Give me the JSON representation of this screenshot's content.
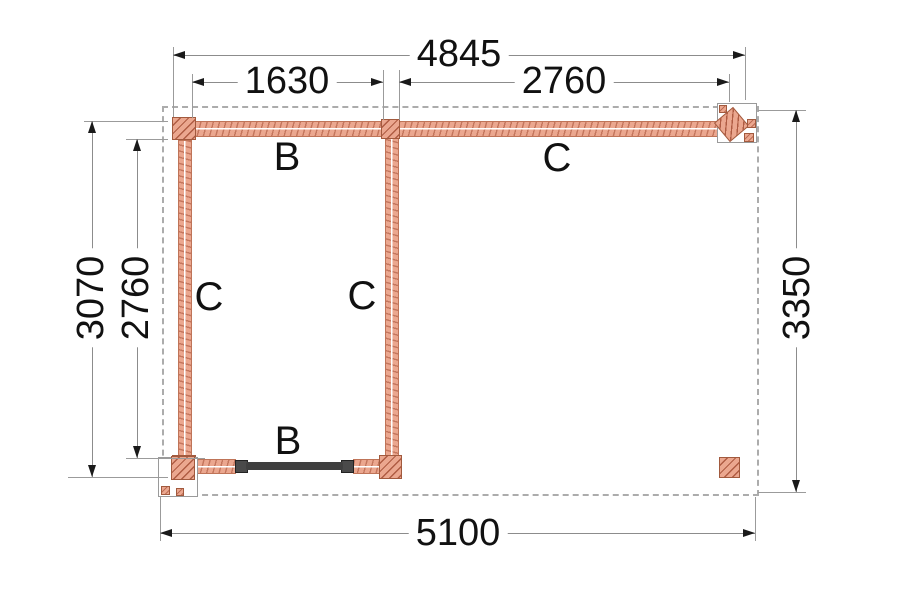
{
  "drawing_type": "veranda-floor-plan",
  "colors": {
    "beam_fill": "#eba78f",
    "beam_edge": "#bf7458",
    "hatch": "#a25a3e",
    "dimension_line": "#8c8c8c",
    "dimension_text": "#111111",
    "roof_outline_dash": "#acacac",
    "dark_bar": "#3f3f3f",
    "background": "#ffffff"
  },
  "dimensions": {
    "top_overall": {
      "label": "4845"
    },
    "top_left_bay": {
      "label": "1630"
    },
    "top_right_bay": {
      "label": "2760"
    },
    "left_outer": {
      "label": "3070"
    },
    "left_inner": {
      "label": "2760"
    },
    "right_side": {
      "label": "3350"
    },
    "bottom_overall": {
      "label": "5100"
    }
  },
  "beam_labels": {
    "top_left_beam": "B",
    "top_right_beam": "C",
    "left_wall_beam": "C",
    "middle_wall_beam": "C",
    "bottom_beam": "B"
  }
}
